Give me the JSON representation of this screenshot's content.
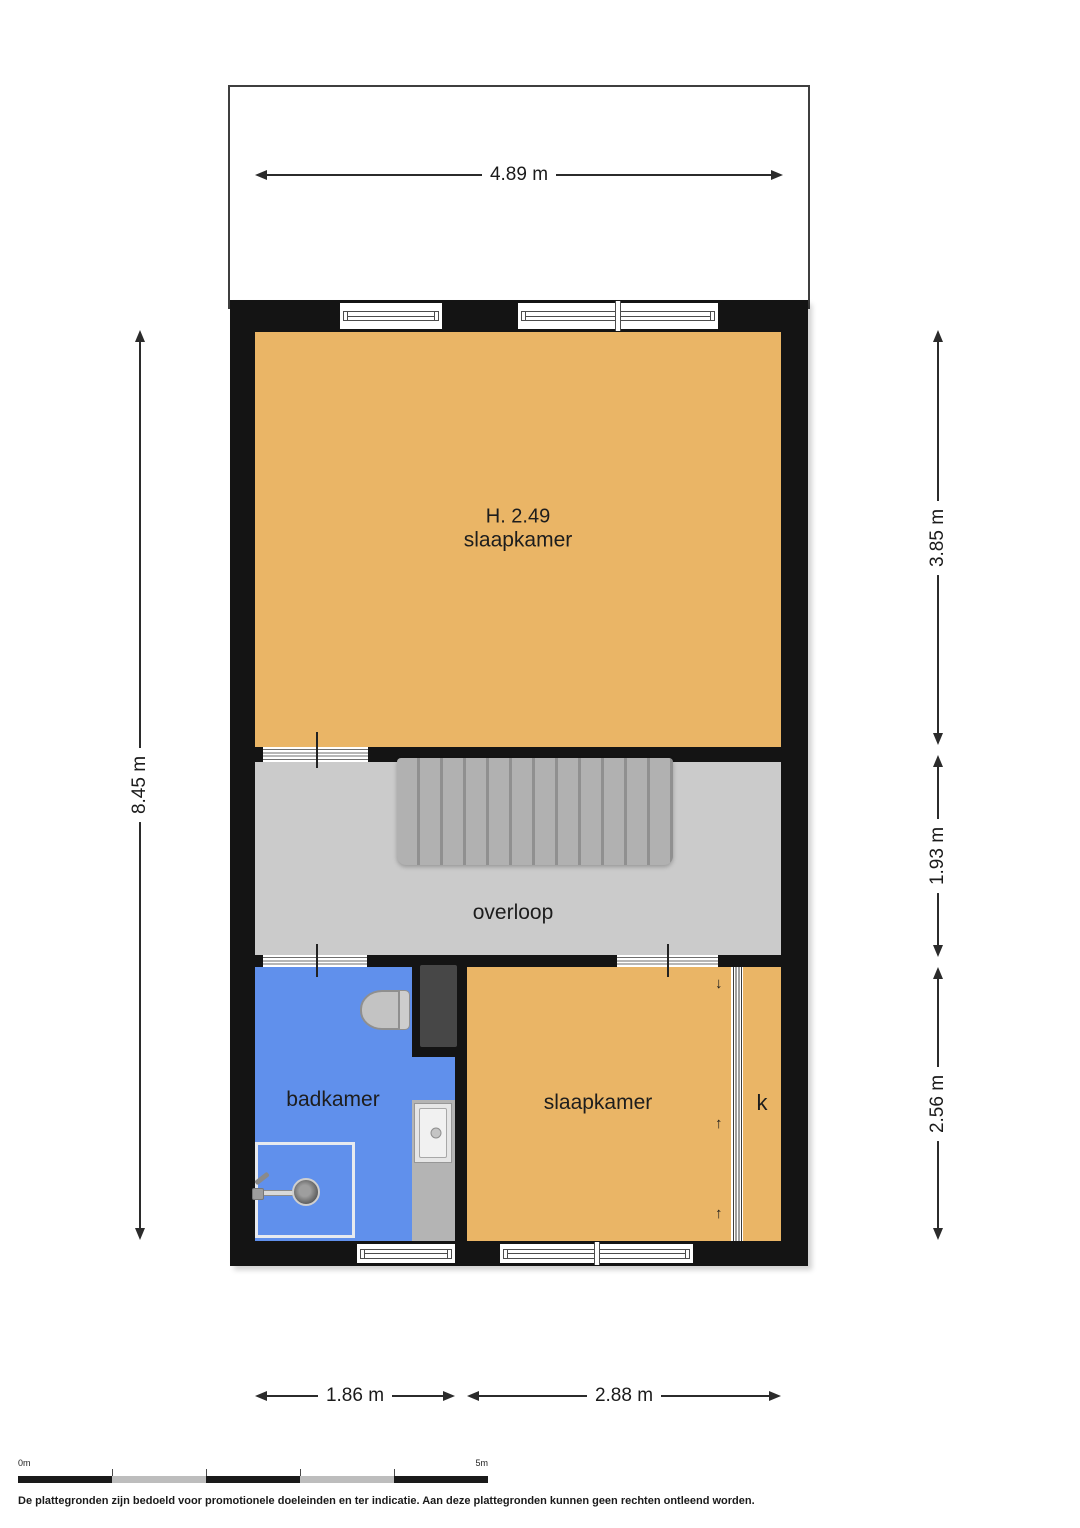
{
  "rooms": {
    "bedroom_main": {
      "height_label": "H. 2.49",
      "name": "slaapkamer"
    },
    "landing": {
      "name": "overloop"
    },
    "bathroom": {
      "name": "badkamer"
    },
    "bedroom_small": {
      "name": "slaapkamer"
    },
    "closet": {
      "name": "k"
    }
  },
  "dimensions": {
    "top_width": "4.89 m",
    "left_height": "8.45 m",
    "right_top": "3.85 m",
    "right_middle": "1.93 m",
    "right_bottom": "2.56 m",
    "bottom_left": "1.86 m",
    "bottom_right": "2.88 m"
  },
  "icons": {
    "closet_arrow_down": "↓",
    "closet_arrow_up": "↑"
  },
  "scale_bar": {
    "start_label": "0m",
    "end_label": "5m"
  },
  "footer": {
    "disclaimer": "De plattegronden zijn bedoeld voor promotionele doeleinden en ter indicatie. Aan deze plattegronden kunnen geen rechten ontleend worden."
  },
  "colors": {
    "room_orange": "#eab566",
    "room_blue": "#6090ec",
    "landing_gray": "#cbcbcb",
    "wall_black": "#141414"
  }
}
